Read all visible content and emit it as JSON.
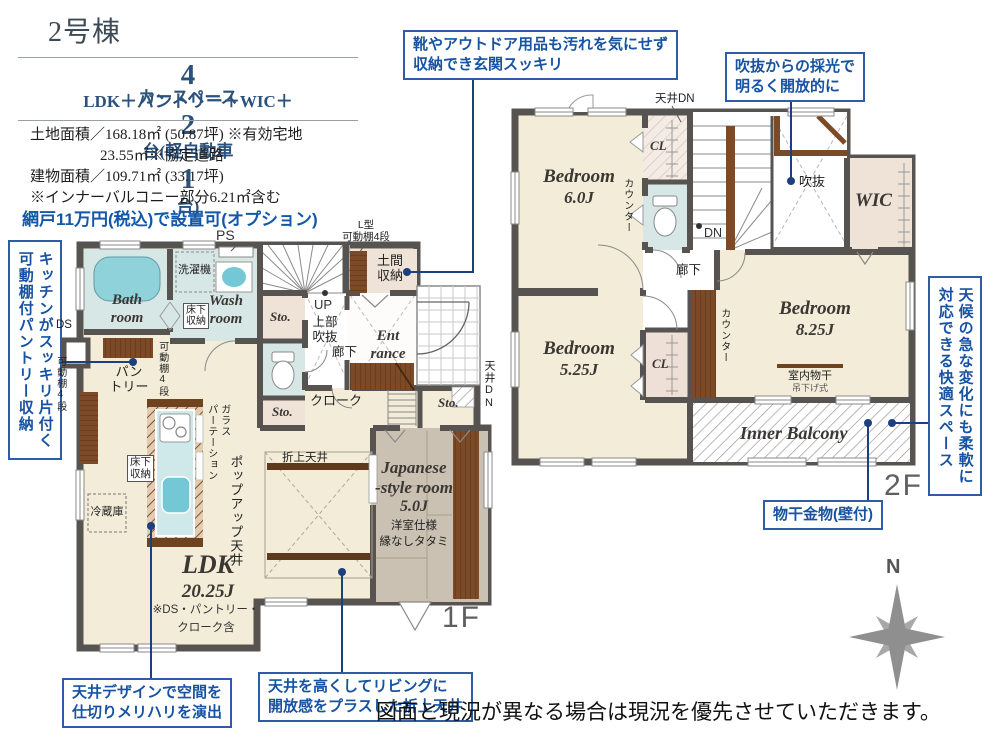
{
  "header": {
    "building": "2号棟",
    "spec": {
      "num1": "4",
      "text1": "LDK＋パントリー＋WIC＋",
      "text2": "カースペース",
      "num2": "2",
      "text3": "台(軽自動車",
      "num3": "1",
      "text4": "台)"
    },
    "land1": "土地面積／168.18㎡ (50.87坪) ※有効宅地",
    "land2": "23.55㎡※協定道路",
    "building_area": "建物面積／109.71㎡ (33.17坪)",
    "note": "※インナーバルコニー部分6.21㎡含む",
    "option": "網戸11万円(税込)で設置可(オプション)"
  },
  "callouts": {
    "genkan1": "靴やアウトドア用品も汚れを気にせず",
    "genkan2": "収納でき玄関スッキリ",
    "void1": "吹抜からの採光で",
    "void2": "明るく開放的に",
    "pantry1": "キッチンがスッキリ片付く",
    "pantry2": "可動棚付パントリー収納",
    "weather1": "天候の急な変化にも柔軟に",
    "weather2": "対応できる快適スペース",
    "monohoshi": "物干金物(壁付)",
    "ceiling1": "天井デザインで空間を",
    "ceiling2": "仕切りメリハリを演出",
    "coffered1": "天井を高くしてリビングに",
    "coffered2": "開放感をプラスした折上天井"
  },
  "f1": {
    "floor": "1F",
    "ps": "PS",
    "ds": "DS",
    "bath1": "Bath",
    "bath2": "room",
    "washer": "洗濯機",
    "wash1": "Wash",
    "wash2": "room",
    "underfloor1": "床下",
    "underfloor2": "収納",
    "sto": "Sto.",
    "doma1": "土間",
    "doma2": "収納",
    "lshelf1": "L型",
    "lshelf2": "可動棚4段",
    "ent1": "Ent",
    "ent2": "rance",
    "up": "UP",
    "upper1": "上部",
    "upper2": "吹抜",
    "hallway": "廊下",
    "cloak": "クローク",
    "ceiling_dn": "天井DN",
    "pantry1": "パン",
    "pantry2": "トリー",
    "shelf4": "可動棚4段",
    "fridge": "冷蔵庫",
    "glass": "ガラス",
    "partition": "パーテーション",
    "popup": "ポップアップ天井",
    "coffered": "折上天井",
    "ldk": "LDK",
    "ldk_size": "20.25J",
    "ldk_note1": "※DS・パントリー・",
    "ldk_note2": "クローク含",
    "jp1": "Japanese",
    "jp2": "-style room",
    "jp3": "5.0J",
    "jp4": "洋室仕様",
    "jp5": "縁なしタタミ"
  },
  "f2": {
    "floor": "2F",
    "ceiling_dn": "天井DN",
    "bed6a": "Bedroom",
    "bed6b": "6.0J",
    "cl": "CL",
    "counter": "カウンター",
    "dn": "DN",
    "hallway": "廊下",
    "void": "吹抜",
    "wic": "WIC",
    "bed525a": "Bedroom",
    "bed525b": "5.25J",
    "bed825a": "Bedroom",
    "bed825b": "8.25J",
    "indoor1": "室内物干",
    "indoor2": "吊下げ式",
    "balcony": "Inner Balcony"
  },
  "compass": {
    "n": "N"
  },
  "footer": {
    "disclaimer": "図面と現況が異なる場合は現況を優先させていただきます。"
  }
}
